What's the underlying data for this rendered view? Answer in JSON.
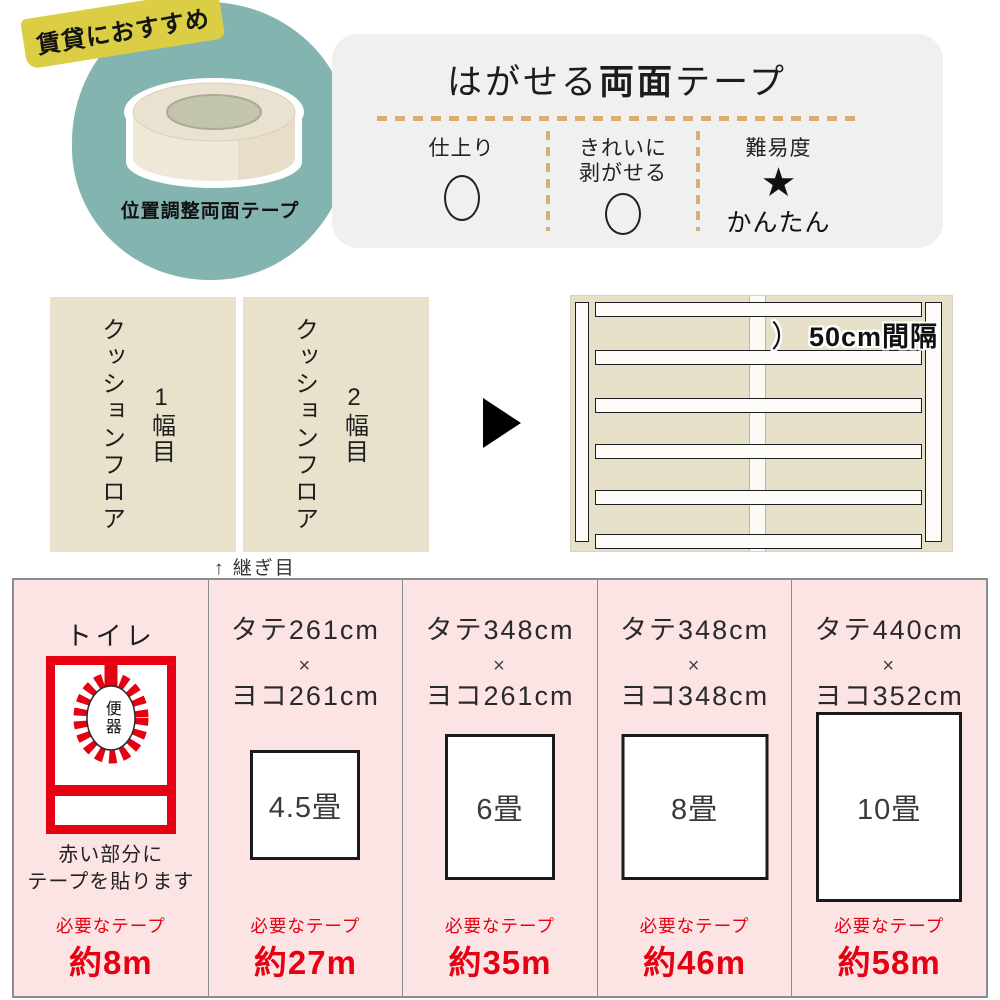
{
  "badge": {
    "label": "賃貸におすすめ"
  },
  "product": {
    "name": "位置調整両面テープ",
    "image": "tape-roll"
  },
  "panel": {
    "title_parts": [
      "はがせる",
      "両面",
      "テープ"
    ],
    "features": [
      {
        "label": "仕上り",
        "value": "circle"
      },
      {
        "label_line1": "きれいに",
        "label_line2": "剥がせる",
        "value": "circle"
      },
      {
        "label": "難易度",
        "value": "★",
        "caption": "かんたん"
      }
    ]
  },
  "floor": {
    "sheets": [
      {
        "name": "クッションフロア",
        "width_label": "1幅目"
      },
      {
        "name": "クッションフロア",
        "width_label": "2幅目"
      }
    ],
    "seam_caption": "↑ 継ぎ目",
    "diagram": {
      "bracket": "）",
      "interval_label": "50cm間隔"
    }
  },
  "table": {
    "toilet": {
      "title": "トイレ",
      "bowl_label": "便器",
      "caption_line1": "赤い部分に",
      "caption_line2": "テープを貼ります",
      "tape_label": "必要なテープ",
      "tape_amount": "約8m"
    },
    "rooms": [
      {
        "tate": "タテ261cm",
        "times": "×",
        "yoko": "ヨコ261cm",
        "size": "4.5畳",
        "tape_label": "必要なテープ",
        "tape_amount": "約27m"
      },
      {
        "tate": "タテ348cm",
        "times": "×",
        "yoko": "ヨコ261cm",
        "size": "6畳",
        "tape_label": "必要なテープ",
        "tape_amount": "約35m"
      },
      {
        "tate": "タテ348cm",
        "times": "×",
        "yoko": "ヨコ348cm",
        "size": "8畳",
        "tape_label": "必要なテープ",
        "tape_amount": "約46m"
      },
      {
        "tate": "タテ440cm",
        "times": "×",
        "yoko": "ヨコ352cm",
        "size": "10畳",
        "tape_label": "必要なテープ",
        "tape_amount": "約58m"
      }
    ]
  },
  "colors": {
    "teal": "#84b4b0",
    "badge_yellow": "#dbce44",
    "panel_gray": "#f0f0ee",
    "dash_tan": "#d9ad74",
    "sheet_beige": "#e8e2cc",
    "cell_pink": "#fce4e4",
    "accent_red": "#e60012",
    "table_border": "#8c8c8c"
  }
}
